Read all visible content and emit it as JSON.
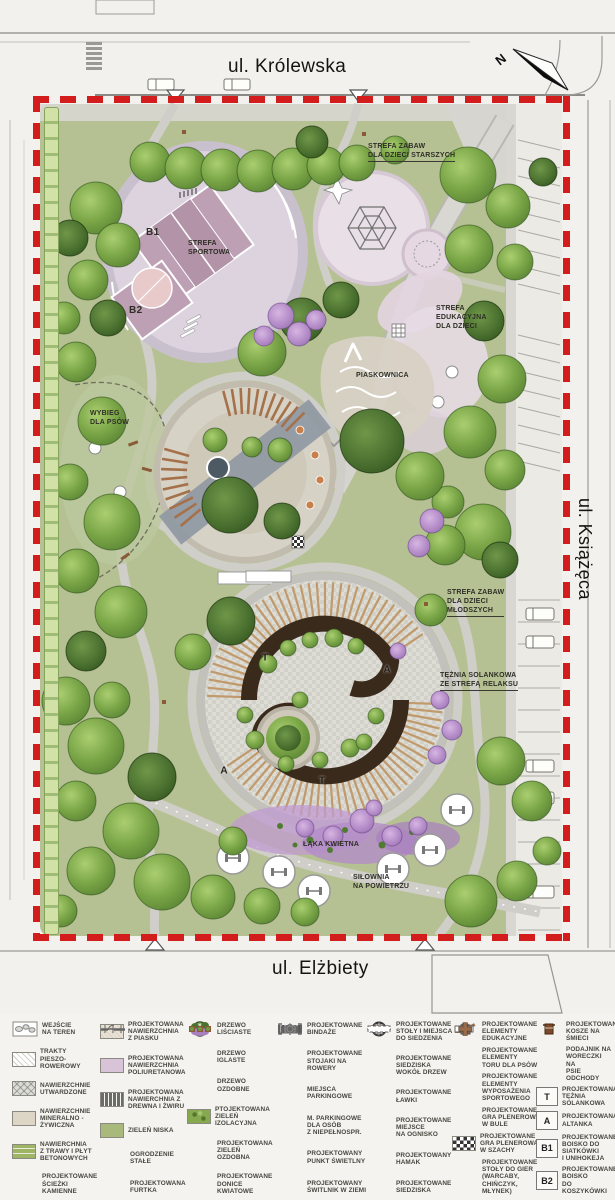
{
  "streets": {
    "top": "ul. Królewska",
    "right": "ul. Książęca",
    "bottom": "ul. Elżbiety"
  },
  "compass": {
    "label": "N"
  },
  "zones": [
    {
      "name": "strefa-zabaw-dzieci-starszych",
      "text": "STREFA ZABAW\nDLA DZIECI STARSZYCH",
      "x": 368,
      "y": 142,
      "underline": true
    },
    {
      "name": "court-b1",
      "text": "B1",
      "x": 146,
      "y": 226,
      "big": true
    },
    {
      "name": "strefa-sportowa",
      "text": "STREFA\nSPORTOWA",
      "x": 188,
      "y": 239
    },
    {
      "name": "court-b2",
      "text": "B2",
      "x": 129,
      "y": 304,
      "big": true
    },
    {
      "name": "strefa-edukacyjna-dla-dzieci",
      "text": "STREFA\nEDUKACYJNA\nDLA DZIECI",
      "x": 436,
      "y": 304
    },
    {
      "name": "piaskownica",
      "text": "PIASKOWNICA",
      "x": 356,
      "y": 371
    },
    {
      "name": "wybieg-dla-psow",
      "text": "WYBIEG\nDLA PSÓW",
      "x": 90,
      "y": 409
    },
    {
      "name": "strefa-zabaw-dzieci-mlodszych",
      "text": "STREFA ZABAW\nDLA DZIECI\nMŁODSZYCH",
      "x": 447,
      "y": 588,
      "underline": true
    },
    {
      "name": "teznia-solankowa",
      "text": "TĘŻNIA SOLANKOWA\nZE STREFĄ RELAKSU",
      "x": 440,
      "y": 671,
      "underline": true
    },
    {
      "name": "laka-kwietna",
      "text": "ŁĄKA KWIETNA",
      "x": 303,
      "y": 840
    },
    {
      "name": "silownia-na-powietrzu",
      "text": "SIŁOWNIA\nNA POWIETRZU",
      "x": 353,
      "y": 873
    }
  ],
  "plaza_letters": [
    {
      "t": "T",
      "x": 265,
      "y": 658
    },
    {
      "t": "A",
      "x": 387,
      "y": 670
    },
    {
      "t": "A",
      "x": 224,
      "y": 771
    },
    {
      "t": "T",
      "x": 322,
      "y": 781
    }
  ],
  "legend": {
    "columns": [
      {
        "items": [
          {
            "icon": "entrance-triangle",
            "label": "WEJŚCIE\nNA TEREN"
          },
          {
            "icon": "hatch-path",
            "label": "TRAKTY\nPIESZO-ROWEROWY"
          },
          {
            "icon": "crosshatch",
            "label": "NAWIERZCHNIE\nUTWARDZONE"
          },
          {
            "icon": "mineral",
            "label": "NAWIERZCHNIE\nMINERALNO -\nŻYWICZNA"
          },
          {
            "icon": "grass-slabs",
            "label": "NAWIERCHNIA\nZ TRAWY I PŁYT\nBETONOWYCH"
          },
          {
            "icon": "stone-path",
            "label": "PROJEKTOWANE\nŚCIEŻKI\nKAMIENNE"
          }
        ]
      },
      {
        "items": [
          {
            "icon": "sand",
            "label": "PROJEKTOWANA\nNAWIERZCHNIA\nZ PIASKU"
          },
          {
            "icon": "polyurethane",
            "label": "PROJEKTOWANA\nNAWIERZCHNIA\nPOLIURETANOWA"
          },
          {
            "icon": "wood-gravel",
            "label": "PROJEKTOWANA\nNAWIERCHNIA Z\nDREWNA I ŻWIRU"
          },
          {
            "icon": "green-low",
            "label": "ZIELEŃ NISKA"
          },
          {
            "icon": "fence",
            "label": "OGRODZENIE\nSTAŁE"
          },
          {
            "icon": "gate",
            "label": "PROJEKTOWANA\nFURTKA"
          }
        ]
      },
      {
        "items": [
          {
            "icon": "tree-leafy",
            "label": "DRZEWO\nLIŚCIASTE"
          },
          {
            "icon": "tree-conifer",
            "label": "DRZEWO\nIGLASTE"
          },
          {
            "icon": "tree-ornamental",
            "label": "DRZEWO\nOZDOBNE"
          },
          {
            "icon": "green-isolation",
            "label": "PTOJEKTOWANA\nZIELEŃ IZOLACYJNA"
          },
          {
            "icon": "green-ornamental",
            "label": "PROJEKTOWANA\nZIELEŃ OZDOBNA"
          },
          {
            "icon": "planters",
            "label": "PROJEKTOWANE\nDONICE\nKWIATOWE"
          }
        ]
      },
      {
        "items": [
          {
            "icon": "bindaze",
            "label": "PROJEKTOWANE\nBINDAŻE"
          },
          {
            "icon": "bike-racks",
            "label": "PROJEKTOWANE\nSTOJAKI NA\nROWERY"
          },
          {
            "icon": "parking",
            "label": "MIEJSCA\nPARKINGOWE"
          },
          {
            "icon": "parking-disabled",
            "label": "M. PARKINGOWE\nDLA OSÓB\nZ NIEPEŁNOSPR."
          },
          {
            "icon": "light-point",
            "label": "PROJEKTOWANY\nPUNKT ŚWIETLNY"
          },
          {
            "icon": "ground-light",
            "label": "PROJEKTOWANY\nŚWITLNIK W ZIEMI"
          }
        ]
      },
      {
        "items": [
          {
            "icon": "tables-seats",
            "label": "PROJEKTOWANE\nSTOŁY I MIEJSCA\nDO SIEDZENIA"
          },
          {
            "icon": "tree-seat",
            "label": "PROJEKTOWANE\nSIEDZISKA\nWOKÓŁ DRZEW"
          },
          {
            "icon": "bench",
            "label": "PROJEKTOWANE\nŁAWKI"
          },
          {
            "icon": "fire-pit",
            "label": "PROJEKTOWANE\nMIEJSCE\nNA OGNISKO"
          },
          {
            "icon": "hammock",
            "label": "PROJEKTOWANY\nHAMAK"
          },
          {
            "icon": "seats-row",
            "label": "PROJEKTOWANE\nSIEDZISKA"
          }
        ]
      },
      {
        "items": [
          {
            "icon": "edu-elements",
            "label": "PROJEKTOWANE\nELEMENTY\nEDUKACYJNE"
          },
          {
            "icon": "dog-course",
            "label": "PROJEKTOWANE\nELEMENTY\nTORU DLA PSÓW"
          },
          {
            "icon": "sport-equipment",
            "label": "PROJEKTOWANE\nELEMENTY\nWYPOSAŻENIA\nSPORTOWEGO"
          },
          {
            "icon": "boules",
            "label": "PROJEKTOWANE\nGRA PLENEROWA\nW BULE"
          },
          {
            "icon": "chess",
            "label": "PROJEKTOWANE\nGRA PLENEROWA\nW SZACHY"
          },
          {
            "icon": "game-tables",
            "label": "PROJEKTOWANE\nSTOŁY DO GIER\n(WARCABY,\nCHIŃCZYK, MŁYNEK)"
          }
        ]
      },
      {
        "items": [
          {
            "icon": "trash",
            "label": "PROJEKTOWANE\nKOSZE NA ŚMIECI"
          },
          {
            "icon": "dog-bags",
            "label": "PODAJNIK NA\nWORECZKI NA\nPSIE ODCHODY"
          },
          {
            "icon": "key-box",
            "key": "T",
            "label": "PROJEKTOWANA\nTĘŻNIA\nSOLANKOWA"
          },
          {
            "icon": "key-box",
            "key": "A",
            "label": "PROJEKTOWANA\nALTANKA"
          },
          {
            "icon": "key-box",
            "key": "B1",
            "label": "PROJEKTOWANE\nBOISKO DO\nSIATKÓWKI\nI UNIHOKEJA"
          },
          {
            "icon": "key-box",
            "key": "B2",
            "label": "PROJEKTOWANE\nBOISKO\nDO KOSZYKÓWKI"
          }
        ]
      }
    ]
  },
  "colors": {
    "boundary": "#d31c1c",
    "lawn": "#b6c193",
    "paving": "#dcdcd6",
    "sport_court": "#bda0b4",
    "play_surface": "#e9dfe7",
    "wood_dark": "#3a2a1b",
    "wood_light": "#c09a6c",
    "ornamental": "#b48cc8"
  }
}
